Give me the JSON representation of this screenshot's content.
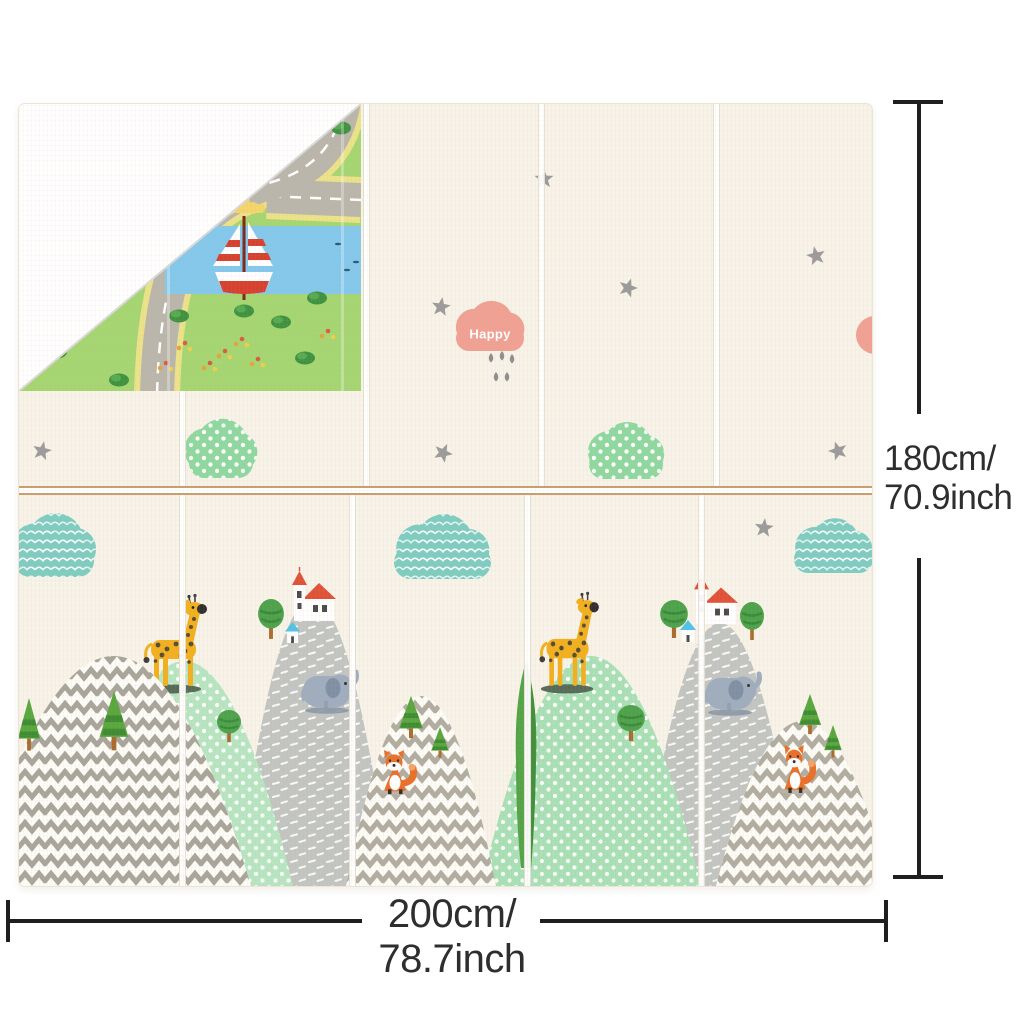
{
  "meta": {
    "width": 1024,
    "height": 1024,
    "background": "#ffffff"
  },
  "dimensions": {
    "height": {
      "line1": "180cm/",
      "line2": "70.9inch"
    },
    "width": {
      "line1": "200cm/",
      "line2": "78.7inch"
    },
    "line_color": "#1f1f1f",
    "text_color": "#2e2e2e"
  },
  "mat": {
    "x": 18,
    "y": 103,
    "w": 853,
    "h": 782,
    "surface": "#f8f3e9",
    "seam_tan": "#c89f6f",
    "half_split_y": 382,
    "upper_seams": [
      160,
      344,
      519,
      694
    ],
    "lower_seams": [
      160,
      330,
      505,
      679
    ]
  },
  "scene": {
    "colors": {
      "star": "#9b9b9b",
      "polka_cloud": "#8fd8a0",
      "wave_cloud": "#7fccc1",
      "happy_pink": "#f0a193",
      "drop_gray": "#8e8e8e",
      "hill_gray": "#c2c5c1",
      "hill_green_b": "#b7e5c1",
      "hill_green_e": "#a9e0b5",
      "chevron": "#b2ada1",
      "chevron_dark": "#a9a59b",
      "chevron_bg": "#fdfcf7",
      "giraffe": "#f2b01e",
      "giraffe_spot": "#3b3b3b",
      "platform": "#566b58",
      "elephant": "#9fadbf",
      "elephant_ear": "#8090a4",
      "elephant_shadow": "#8b97a7",
      "fox": "#e8702a",
      "fox_dark": "#3a2e24",
      "church_red": "#e05238",
      "hut_blue": "#4fc3e8",
      "tree_green": "#4da24b",
      "tree_dark": "#3a8a3a",
      "trunk": "#aa6c2e",
      "pine": "#58a73f",
      "pine_dark": "#3f8c33",
      "window": "#4a4a4a",
      "white": "#ffffff"
    },
    "stars": [
      [
        525,
        75
      ],
      [
        609,
        184
      ],
      [
        797,
        152
      ],
      [
        422,
        203
      ],
      [
        424,
        349
      ],
      [
        819,
        347
      ],
      [
        23,
        347
      ],
      [
        745,
        424
      ]
    ],
    "star_rotations": [
      0,
      18,
      -12,
      8,
      25,
      -18,
      12,
      6
    ],
    "happy_cloud": {
      "x": 437,
      "y": 203,
      "w": 68,
      "h": 44,
      "label": "Happy"
    },
    "raindrops": [
      [
        472,
        249
      ],
      [
        483,
        247
      ],
      [
        493,
        250
      ],
      [
        477,
        268
      ],
      [
        488,
        268
      ]
    ],
    "polka_clouds": [
      [
        170,
        322,
        64,
        52
      ],
      [
        570,
        325,
        74,
        50
      ]
    ],
    "wave_clouds": [
      [
        -5,
        417,
        80,
        56
      ],
      [
        375,
        418,
        97,
        57
      ],
      [
        775,
        421,
        79,
        48
      ]
    ],
    "pink_half_cloud": {
      "cx": 856,
      "cy": 231,
      "r": 19
    },
    "layers": [
      {
        "t": "dome",
        "pattern": "pDash",
        "fillKey": "hill_gray",
        "x0": 217,
        "cx": 292,
        "cy": 208,
        "x1": 372,
        "name": "gray-hill"
      },
      {
        "t": "dome",
        "pattern": "pDash",
        "fillKey": "hill_gray",
        "x0": 622,
        "cx": 700,
        "cy": 256,
        "x1": 782,
        "name": "gray-hill"
      },
      {
        "t": "tree",
        "x": 238,
        "y": 494,
        "w": 28,
        "h": 42
      },
      {
        "t": "church",
        "x": 273,
        "y": 465,
        "w": 42,
        "h": 54
      },
      {
        "t": "hut",
        "x": 266,
        "y": 518,
        "w": 15,
        "h": 21
      },
      {
        "t": "elephant",
        "x": 282,
        "y": 559,
        "w": 54,
        "h": 50
      },
      {
        "t": "tree",
        "x": 640,
        "y": 495,
        "w": 30,
        "h": 40
      },
      {
        "t": "tree",
        "x": 720,
        "y": 497,
        "w": 26,
        "h": 40
      },
      {
        "t": "church",
        "x": 675,
        "y": 470,
        "w": 42,
        "h": 52
      },
      {
        "t": "hut",
        "x": 661,
        "y": 516,
        "w": 16,
        "h": 22
      },
      {
        "t": "elephant",
        "x": 685,
        "y": 561,
        "w": 54,
        "h": 50
      },
      {
        "t": "dome",
        "pattern": "pDots",
        "fillKey": "hill_green_b",
        "x0": 57,
        "cx": 165,
        "cy": 332,
        "x1": 274,
        "name": "green-hill"
      },
      {
        "t": "dome",
        "pattern": "pDots",
        "fillKey": "hill_green_e",
        "x0": 462,
        "cx": 572,
        "cy": 322,
        "x1": 682,
        "name": "green-hill"
      },
      {
        "t": "tree",
        "x": 98,
        "y": 557,
        "w": 22,
        "h": 46
      },
      {
        "t": "tree",
        "x": 197,
        "y": 605,
        "w": 26,
        "h": 34
      },
      {
        "t": "tree",
        "x": 597,
        "y": 600,
        "w": 30,
        "h": 38
      },
      {
        "t": "giraffe",
        "x": 124,
        "y": 495,
        "w": 62,
        "h": 94
      },
      {
        "t": "giraffe",
        "x": 520,
        "y": 493,
        "w": 58,
        "h": 96
      },
      {
        "t": "dome",
        "pattern": "pChevD",
        "fillKey": "chevron_bg",
        "x0": -48,
        "cx": 97,
        "cy": 322,
        "x1": 232,
        "name": "zigzag-hill"
      },
      {
        "t": "dome",
        "pattern": "pChev",
        "fillKey": "chevron_bg",
        "x0": 327,
        "cx": 402,
        "cy": 402,
        "x1": 477,
        "name": "zigzag-hill"
      },
      {
        "t": "dome",
        "pattern": "pChev",
        "fillKey": "chevron_bg",
        "x0": 697,
        "cx": 782,
        "cy": 452,
        "x1": 872,
        "name": "zigzag-hill"
      },
      {
        "t": "pine",
        "x": 77,
        "y": 587,
        "w": 36,
        "h": 62
      },
      {
        "t": "pine",
        "x": -4,
        "y": 594,
        "w": 28,
        "h": 55
      },
      {
        "t": "pine",
        "x": 377,
        "y": 592,
        "w": 30,
        "h": 44
      },
      {
        "t": "pine",
        "x": 410,
        "y": 623,
        "w": 22,
        "h": 32
      },
      {
        "t": "pine",
        "x": 777,
        "y": 590,
        "w": 28,
        "h": 42
      },
      {
        "t": "pine",
        "x": 803,
        "y": 621,
        "w": 22,
        "h": 34
      },
      {
        "t": "fox",
        "x": 356,
        "y": 647,
        "w": 44,
        "h": 44
      },
      {
        "t": "fox",
        "x": 757,
        "y": 642,
        "w": 42,
        "h": 48
      },
      {
        "t": "cypress",
        "x": 493,
        "y": 557,
        "w": 28,
        "h": 207
      }
    ]
  },
  "fold": {
    "w": 342,
    "h": 287,
    "grass": "#a5d672",
    "road": "#bab6ab",
    "road_edge": "#ece289",
    "river": "#84c8ec",
    "boat_red": "#d6402e",
    "mast": "#7e2418",
    "sun": "#f3d56b",
    "bush": "#3f9340",
    "bush_light": "#57aa52",
    "edge_line": "#d9d9d9",
    "roads": [
      {
        "d": "M 342,96 L 248,92"
      },
      {
        "d": "M 326,-16 Q 322,58 253,78 Q 184,98 161,150 Q 140,200 138,292"
      }
    ],
    "river_rect": [
      146,
      122,
      200,
      68
    ],
    "fish": [
      [
        319,
        140
      ],
      [
        337,
        158
      ],
      [
        328,
        166
      ]
    ],
    "bushes": [
      [
        38,
        248
      ],
      [
        100,
        276
      ],
      [
        160,
        212
      ],
      [
        225,
        207
      ],
      [
        298,
        194
      ],
      [
        286,
        254
      ],
      [
        322,
        24
      ],
      [
        262,
        218
      ]
    ],
    "flowers": [
      [
        165,
        242
      ],
      [
        205,
        250
      ],
      [
        238,
        258
      ],
      [
        146,
        262
      ],
      [
        308,
        230
      ],
      [
        190,
        262
      ],
      [
        222,
        238
      ]
    ],
    "flower_colors": [
      "#e3a43b",
      "#d95f3b",
      "#edd04a"
    ],
    "boat": {
      "x": 225,
      "y": 112
    },
    "sun_pos": {
      "x": 218,
      "y": 100
    },
    "kite": {
      "x": 192,
      "y": 96
    },
    "seam_ghosts": [
      148,
      322
    ]
  }
}
